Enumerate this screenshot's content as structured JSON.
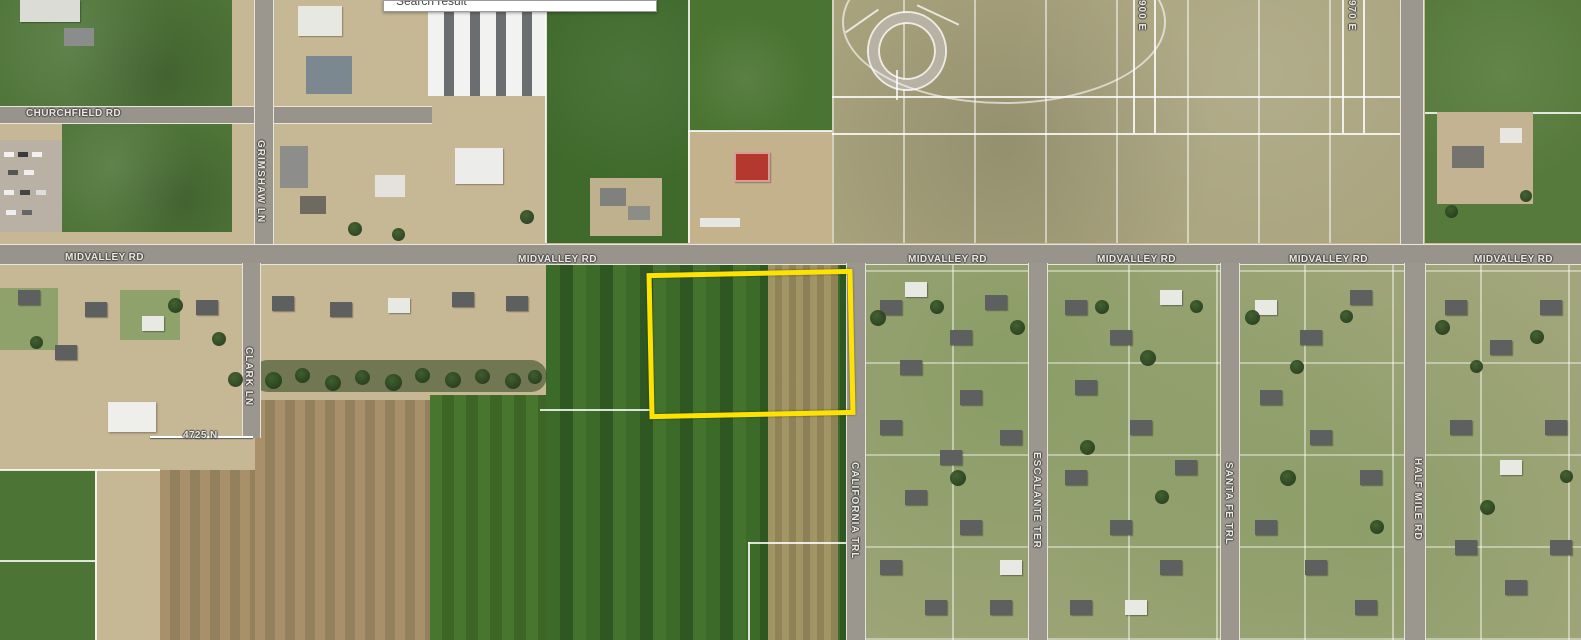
{
  "search": {
    "label": "Search result"
  },
  "map": {
    "highlight_color": "#ffe300",
    "labels": {
      "churchfield": "CHURCHFIELD RD",
      "midvalley": "MIDVALLEY RD",
      "grimshaw": "GRIMSHAW LN",
      "clark": "CLARK LN",
      "marker_4725n": "4725 N",
      "california": "CALIFORNIA TRL",
      "escalante": "ESCALANTE TER",
      "santa_fe": "SANTA FE TRL",
      "half_mile": "HALF MILE RD",
      "e900": "900 E",
      "e970": "970 E"
    }
  }
}
